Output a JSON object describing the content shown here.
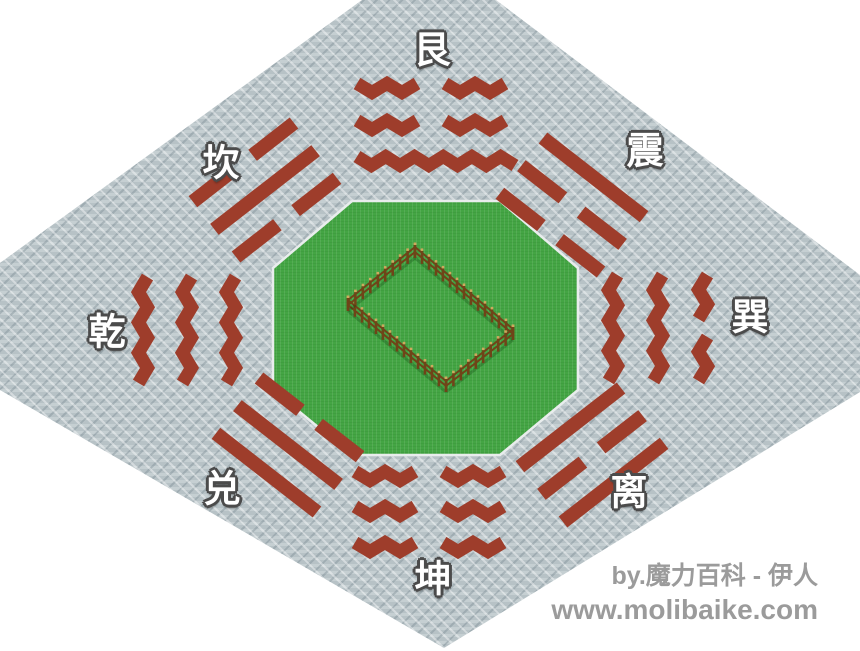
{
  "scene": {
    "type": "isometric-game-map",
    "subject": "bagua-eight-trigrams-formation",
    "colors": {
      "background": "#ffffff",
      "stone": "#b7c2c6",
      "brick": "#9e3d2b",
      "grass": "#44a544",
      "courtyard_border": "#e9eded",
      "fence_wood": "#6f4418",
      "fence_cap": "#cfa95e",
      "label_fill": "#ffffff",
      "label_outline": "#4b4b4b",
      "watermark": "#9b9b9b"
    }
  },
  "trigrams": [
    {
      "label": "艮",
      "name": "gen",
      "position": "top",
      "lines_outer_to_inner": [
        "broken",
        "broken",
        "solid"
      ]
    },
    {
      "label": "震",
      "name": "zhen",
      "position": "top-right",
      "lines_outer_to_inner": [
        "solid",
        "broken",
        "broken"
      ]
    },
    {
      "label": "巽",
      "name": "xun",
      "position": "right",
      "lines_outer_to_inner": [
        "broken",
        "solid",
        "solid"
      ]
    },
    {
      "label": "离",
      "name": "li",
      "position": "bottom-right",
      "lines_outer_to_inner": [
        "solid",
        "broken",
        "solid"
      ]
    },
    {
      "label": "坤",
      "name": "kun",
      "position": "bottom",
      "lines_outer_to_inner": [
        "broken",
        "broken",
        "broken"
      ]
    },
    {
      "label": "兑",
      "name": "dui",
      "position": "bottom-left",
      "lines_outer_to_inner": [
        "solid",
        "solid",
        "broken"
      ]
    },
    {
      "label": "乾",
      "name": "qian",
      "position": "left",
      "lines_outer_to_inner": [
        "solid",
        "solid",
        "solid"
      ]
    },
    {
      "label": "坎",
      "name": "kan",
      "position": "top-left",
      "lines_outer_to_inner": [
        "broken",
        "solid",
        "broken"
      ]
    }
  ],
  "watermark": {
    "credit": "by.魔力百科 - 伊人",
    "site": "www.molibaike.com"
  }
}
